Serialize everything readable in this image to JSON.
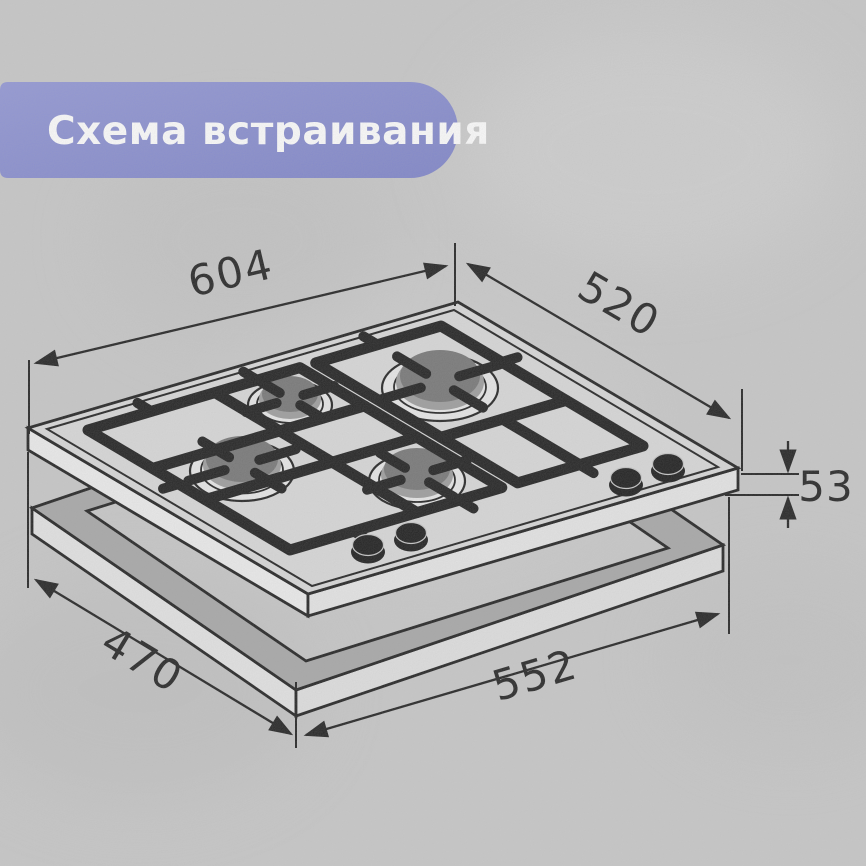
{
  "page": {
    "background_color": "#C8C8C8"
  },
  "banner": {
    "title": "Схема встраивания",
    "background_color": "#858ACE",
    "text_color": "#FFFFFF"
  },
  "diagram": {
    "dimensions": {
      "top_width": "604",
      "top_depth": "520",
      "body_height": "53",
      "cutout_depth": "470",
      "cutout_width": "552"
    },
    "colors": {
      "line": "#1C1C1C",
      "hob_surface": "#D9D9D9",
      "burner_cap": "#747474",
      "grate": "#1A1A1A",
      "cutout_frame_top": "#A7A7A7"
    }
  }
}
